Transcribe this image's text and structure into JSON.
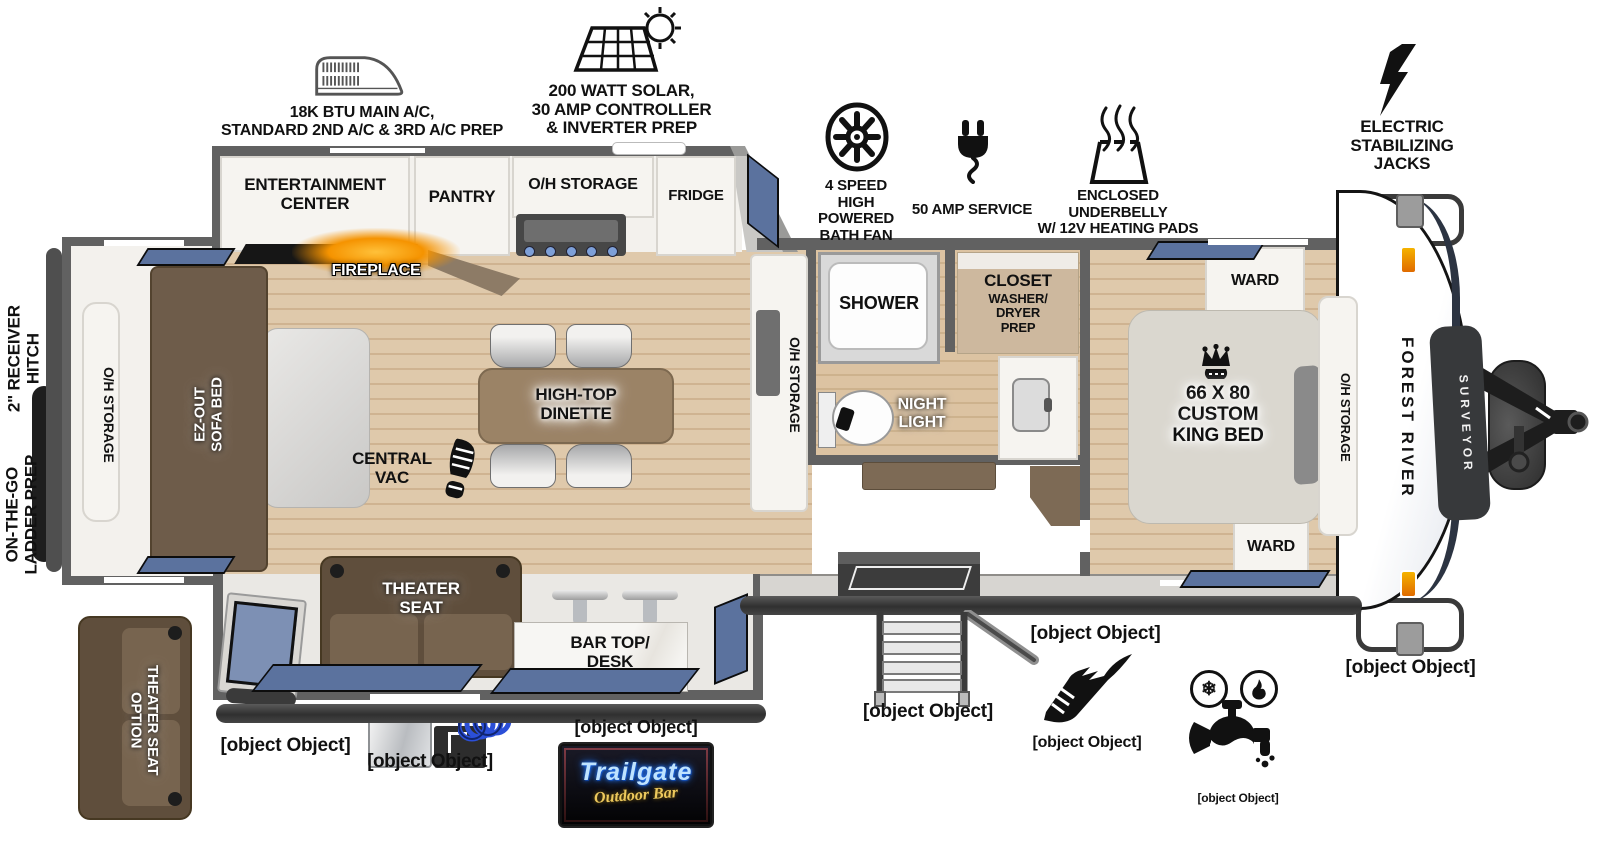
{
  "features": {
    "ac": {
      "label": "18K BTU MAIN A/C,\nSTANDARD 2ND A/C & 3RD A/C PREP"
    },
    "solar": {
      "label": "200 WATT SOLAR,\n30 AMP CONTROLLER\n& INVERTER PREP"
    },
    "bath_fan": {
      "label": "4 SPEED\nHIGH POWERED\nBATH FAN"
    },
    "amp_service": {
      "label": "50 AMP SERVICE"
    },
    "underbelly": {
      "label": "ENCLOSED UNDERBELLY\nW/ 12V HEATING PADS"
    },
    "stab_jacks": {
      "label": "ELECTRIC\nSTABILIZING\nJACKS"
    },
    "receiver_hitch": {
      "label": "2\" RECEIVER\nHITCH"
    },
    "ladder_prep": {
      "label": "ON-THE-GO\nLADDER PREP"
    },
    "slam_latch": {
      "label": "SLAM-LATCH\nCARGO DOORS"
    },
    "awning_11": {
      "label": "11’ AWNING"
    },
    "awning_12": {
      "label": "12’ AWNING"
    },
    "outside_kitchen": {
      "label": "OUTSIDE KITCHEN"
    },
    "flip_up_window": {
      "label": "FLIP-UP WINDOW"
    },
    "entry_step": {
      "label": "SOLID ENTRY\nSTEP"
    },
    "goodyear": {
      "label": "GOODYEAR®\nTIRES & TPMS"
    },
    "spray_port": {
      "label": "HOT & COLD EXTERIOR\nSPRAY PORT"
    }
  },
  "interior": {
    "entertainment": "ENTERTAINMENT\nCENTER",
    "pantry": "PANTRY",
    "oh_storage": "O/H STORAGE",
    "fridge": "FRIDGE",
    "fireplace": "FIREPLACE",
    "ez_sofa": "EZ-OUT\nSOFA BED",
    "dinette": "HIGH-TOP\nDINETTE",
    "central_vac": "CENTRAL\nVAC",
    "shower": "SHOWER",
    "closet_title": "CLOSET",
    "closet_sub": "WASHER/\nDRYER\nPREP",
    "night_light": "NIGHT\nLIGHT",
    "ward": "WARD",
    "king_bed": "66 X 80\nCUSTOM\nKING BED",
    "theater_seat": "THEATER\nSEAT",
    "bar_top": "BAR TOP/\nDESK",
    "theater_seat_option": "THEATER SEAT\nOPTION"
  },
  "branding": {
    "make": "FOREST RIVER",
    "model": "SURVEYOR",
    "logo_title": "Trailgate",
    "logo_subtitle": "Outdoor Bar"
  },
  "colors": {
    "window_blue": "#5b729e",
    "fireplace_orange": "#f59300",
    "wood_floor": "#dfc9ab",
    "sofa_brown": "#6e5c4a",
    "wall_gray": "#616161",
    "logo_red": "#d94f4f",
    "logo_neon_blue": "#9fd7ff",
    "logo_yellow": "#edc95d"
  }
}
